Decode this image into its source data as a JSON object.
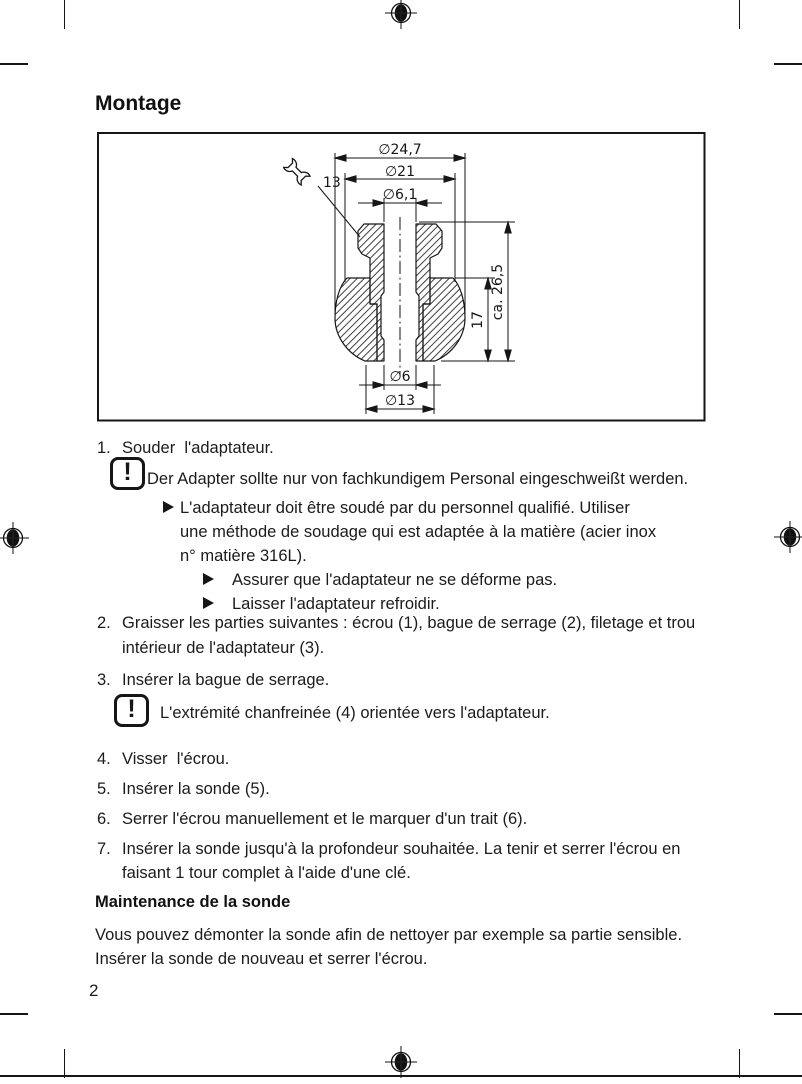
{
  "title": "Montage",
  "page_number": "2",
  "figure": {
    "caption": "technical drawing: weld-in adapter cross-section",
    "wrench_label": "13",
    "dims": {
      "d_outer": "∅24,7",
      "d_mid": "∅21",
      "d_hole_top": "∅6,1",
      "d_hole_bottom": "∅6",
      "d_stub": "∅13",
      "h_sphere": "17",
      "h_total": "ca. 26,5"
    }
  },
  "steps": [
    {
      "num": "1.",
      "lines": [
        "Souder  l'adaptateur."
      ]
    },
    {
      "num": "2.",
      "lines": [
        "Graisser les parties suivantes : écrou (1), bague de serrage (2), filetage et trou",
        "intérieur de l'adaptateur (3)."
      ]
    },
    {
      "num": "3.",
      "lines": [
        "Insérer la bague de serrage."
      ]
    },
    {
      "num": "4.",
      "lines": [
        "Visser  l'écrou."
      ]
    },
    {
      "num": "5.",
      "lines": [
        "Insérer la sonde (5)."
      ]
    },
    {
      "num": "6.",
      "lines": [
        "Serrer l'écrou manuellement et le marquer d'un trait (6)."
      ]
    },
    {
      "num": "7.",
      "lines": [
        "Insérer la sonde jusqu'à la profondeur souhaitée. La tenir et serrer l'écrou en",
        "faisant 1 tour complet à l'aide d'une clé."
      ]
    }
  ],
  "note1": {
    "icon_glyph": "!",
    "line_de": "Der Adapter sollte nur von fachkundigem Personal eingeschweißt werden.",
    "bullet1_lines": [
      "L'adaptateur doit être soudé par du personnel qualifié. Utiliser",
      "une méthode de soudage qui est adaptée à la matière (acier inox",
      "n° matière 316L)."
    ],
    "sub_bullets": [
      "Assurer que l'adaptateur ne se déforme pas.",
      "Laisser l'adaptateur refroidir."
    ]
  },
  "note2": {
    "icon_glyph": "!",
    "text": "L'extrémité chanfreinée (4) orientée vers l'adaptateur."
  },
  "maintenance": {
    "heading": "Maintenance de la sonde",
    "lines": [
      "Vous pouvez démonter la sonde afin de nettoyer par exemple sa partie sensible.",
      "Insérer la sonde de nouveau et serrer l'écrou."
    ]
  }
}
